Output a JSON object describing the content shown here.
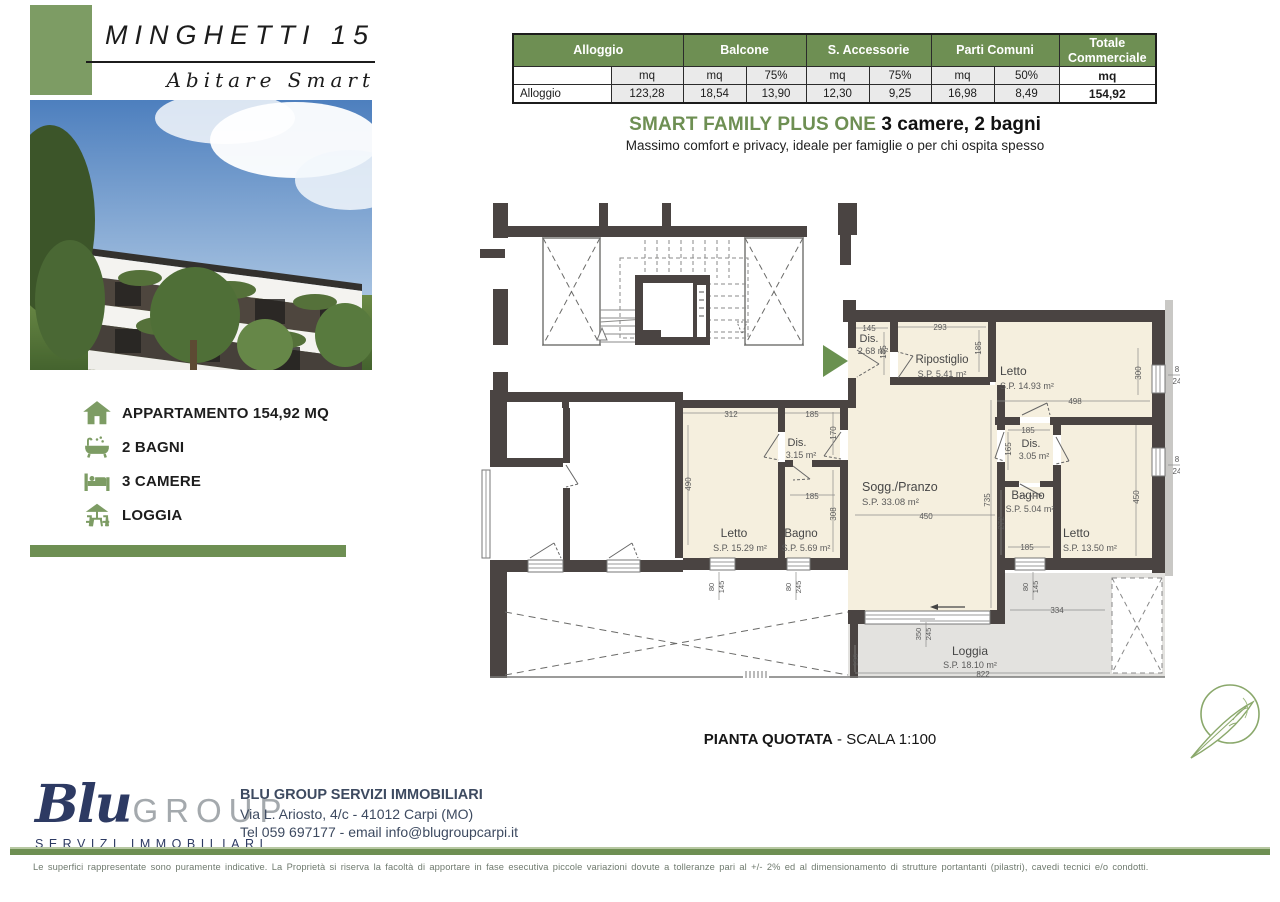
{
  "colors": {
    "green": "#6e8f53",
    "green_block": "#7d9c64",
    "navy": "#2d3a63",
    "wall": "#4a4442",
    "room_beige": "#f5efde",
    "loggia_gray": "#e3e2df"
  },
  "header": {
    "title": "MINGHETTI 15",
    "subtitle": "Abitare Smart"
  },
  "table": {
    "groups": [
      "Alloggio",
      "Balcone",
      "S. Accessorie",
      "Parti Comuni",
      "Totale Commerciale"
    ],
    "units_row": [
      "",
      "mq",
      "mq",
      "75%",
      "mq",
      "75%",
      "mq",
      "50%",
      "mq"
    ],
    "data_row": [
      "Alloggio",
      "123,28",
      "18,54",
      "13,90",
      "12,30",
      "9,25",
      "16,98",
      "8,49",
      "154,92"
    ]
  },
  "headline": {
    "title": "SMART FAMILY PLUS ONE",
    "suffix": " 3 camere, 2 bagni",
    "subtitle": "Massimo comfort e privacy, ideale per famiglie o per chi ospita spesso"
  },
  "features": [
    {
      "icon": "house-icon",
      "label": "APPARTAMENTO 154,92 MQ"
    },
    {
      "icon": "bathtub-icon",
      "label": "2 BAGNI"
    },
    {
      "icon": "bed-icon",
      "label": "3 CAMERE"
    },
    {
      "icon": "patio-icon",
      "label": "LOGGIA"
    }
  ],
  "plan": {
    "caption_bold": "PIANTA QUOTATA",
    "caption_rest": " - SCALA 1:100",
    "labels": [
      {
        "t": "Dis.",
        "x": 869,
        "y": 342,
        "s": 11
      },
      {
        "t": "2.68 m²",
        "x": 873,
        "y": 354,
        "s": 9
      },
      {
        "t": "145",
        "x": 869,
        "y": 331,
        "s": 8
      },
      {
        "t": "185",
        "x": 886,
        "y": 352,
        "s": 8,
        "r": -90
      },
      {
        "t": "Ripostiglio",
        "x": 942,
        "y": 363,
        "s": 11.5
      },
      {
        "t": "S.P. 5.41 m²",
        "x": 942,
        "y": 377,
        "s": 9
      },
      {
        "t": "293",
        "x": 940,
        "y": 330,
        "s": 8
      },
      {
        "t": "185",
        "x": 981,
        "y": 348,
        "s": 8,
        "r": -90
      },
      {
        "t": "Letto",
        "x": 1000,
        "y": 375,
        "s": 12,
        "a": "start"
      },
      {
        "t": "S.P. 14.93 m²",
        "x": 1000,
        "y": 389,
        "s": 9,
        "a": "start"
      },
      {
        "t": "498",
        "x": 1075,
        "y": 404,
        "s": 8
      },
      {
        "t": "300",
        "x": 1141,
        "y": 373,
        "s": 8,
        "r": -90
      },
      {
        "t": "8",
        "x": 1177,
        "y": 372,
        "s": 8
      },
      {
        "t": "24",
        "x": 1177,
        "y": 384,
        "s": 8
      },
      {
        "t": "8",
        "x": 1177,
        "y": 462,
        "s": 8
      },
      {
        "t": "24",
        "x": 1177,
        "y": 474,
        "s": 8
      },
      {
        "t": "Sogg./Pranzo",
        "x": 862,
        "y": 491,
        "s": 12.5,
        "a": "start"
      },
      {
        "t": "S.P. 33.08 m²",
        "x": 862,
        "y": 505,
        "s": 9.5,
        "a": "start"
      },
      {
        "t": "450",
        "x": 926,
        "y": 519,
        "s": 8
      },
      {
        "t": "735",
        "x": 990,
        "y": 500,
        "s": 8,
        "r": -90
      },
      {
        "t": "272",
        "x": 1004,
        "y": 523,
        "s": 8,
        "r": -90
      },
      {
        "t": "185",
        "x": 1028,
        "y": 433,
        "s": 8
      },
      {
        "t": "Dis.",
        "x": 1031,
        "y": 447,
        "s": 11
      },
      {
        "t": "3.05 m²",
        "x": 1034,
        "y": 459,
        "s": 9
      },
      {
        "t": "165",
        "x": 1011,
        "y": 449,
        "s": 8,
        "r": -90
      },
      {
        "t": "Bagno",
        "x": 1028,
        "y": 499,
        "s": 11.5
      },
      {
        "t": "S.P. 5.04 m²",
        "x": 1030,
        "y": 512,
        "s": 9
      },
      {
        "t": "185",
        "x": 1027,
        "y": 550,
        "s": 8
      },
      {
        "t": "Letto",
        "x": 1063,
        "y": 537,
        "s": 12,
        "a": "start"
      },
      {
        "t": "S.P. 13.50 m²",
        "x": 1063,
        "y": 551,
        "s": 9,
        "a": "start"
      },
      {
        "t": "450",
        "x": 1139,
        "y": 497,
        "s": 8,
        "r": -90
      },
      {
        "t": "312",
        "x": 731,
        "y": 417,
        "s": 8
      },
      {
        "t": "185",
        "x": 812,
        "y": 417,
        "s": 8
      },
      {
        "t": "170",
        "x": 836,
        "y": 433,
        "s": 8,
        "r": -90
      },
      {
        "t": "490",
        "x": 691,
        "y": 484,
        "s": 8,
        "r": -90
      },
      {
        "t": "Dis.",
        "x": 797,
        "y": 446,
        "s": 11
      },
      {
        "t": "3.15 m²",
        "x": 801,
        "y": 458,
        "s": 9
      },
      {
        "t": "185",
        "x": 812,
        "y": 499,
        "s": 8
      },
      {
        "t": "308",
        "x": 836,
        "y": 514,
        "s": 8,
        "r": -90
      },
      {
        "t": "Letto",
        "x": 734,
        "y": 537,
        "s": 12
      },
      {
        "t": "S.P. 15.29 m²",
        "x": 740,
        "y": 551,
        "s": 9
      },
      {
        "t": "Bagno",
        "x": 801,
        "y": 537,
        "s": 11.5
      },
      {
        "t": "S.P. 5.69 m²",
        "x": 806,
        "y": 551,
        "s": 9
      },
      {
        "t": "80",
        "x": 714,
        "y": 587,
        "s": 7.5,
        "r": -90
      },
      {
        "t": "145",
        "x": 724,
        "y": 587,
        "s": 7.5,
        "r": -90
      },
      {
        "t": "80",
        "x": 791,
        "y": 587,
        "s": 7.5,
        "r": -90
      },
      {
        "t": "245",
        "x": 801,
        "y": 587,
        "s": 7.5,
        "r": -90
      },
      {
        "t": "80",
        "x": 1028,
        "y": 587,
        "s": 7.5,
        "r": -90
      },
      {
        "t": "145",
        "x": 1038,
        "y": 587,
        "s": 7.5,
        "r": -90
      },
      {
        "t": "334",
        "x": 1057,
        "y": 613,
        "s": 8
      },
      {
        "t": "350",
        "x": 921,
        "y": 634,
        "s": 7.5,
        "r": -90
      },
      {
        "t": "245",
        "x": 931,
        "y": 634,
        "s": 7.5,
        "r": -90
      },
      {
        "t": "150",
        "x": 858,
        "y": 660,
        "s": 7.5,
        "r": -90
      },
      {
        "t": "Loggia",
        "x": 970,
        "y": 655,
        "s": 12
      },
      {
        "t": "S.P. 18.10 m²",
        "x": 970,
        "y": 668,
        "s": 9
      },
      {
        "t": "822",
        "x": 983,
        "y": 677,
        "s": 8
      }
    ]
  },
  "footer": {
    "logo_blu": "Blu",
    "logo_group": "GROUP",
    "logo_sub": "SERVIZI IMMOBILIARI",
    "company": "BLU GROUP SERVIZI IMMOBILIARI",
    "address": "Via L. Ariosto, 4/c - 41012 Carpi (MO)",
    "contact": "Tel 059 697177 - email info@blugroupcarpi.it",
    "disclaimer": "Le superfici rappresentate sono puramente indicative. La Proprietà si riserva la facoltà di apportare in fase esecutiva piccole variazioni dovute a tolleranze pari al +/- 2% ed al dimensionamento di strutture portantanti (pilastri), cavedi tecnici e/o condotti."
  }
}
